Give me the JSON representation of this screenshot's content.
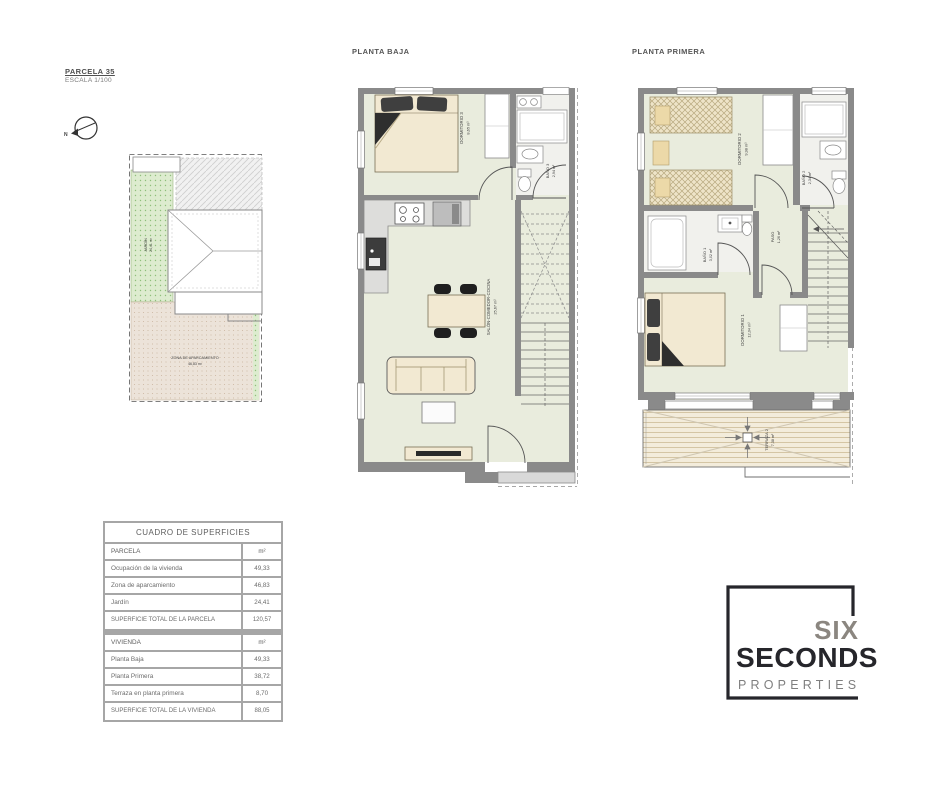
{
  "meta": {
    "parcela_title": "PARCELA 35",
    "escala": "ESCALA 1/100"
  },
  "plans": {
    "baja": {
      "label": "PLANTA BAJA",
      "rooms": [
        {
          "name": "DORMITORIO 3",
          "area": "8,65 m²"
        },
        {
          "name": "BAÑO 3",
          "area": "2,94 m²"
        },
        {
          "name": "SALÓN-COMEDOR-COCINA",
          "area": "25,67 m²"
        }
      ]
    },
    "primera": {
      "label": "PLANTA PRIMERA",
      "rooms": [
        {
          "name": "DORMITORIO 2",
          "area": "9,98 m²"
        },
        {
          "name": "BAÑO 2",
          "area": "2,34 m²"
        },
        {
          "name": "BAÑO 1",
          "area": "3,02 m²"
        },
        {
          "name": "PASO",
          "area": "1,26 m²"
        },
        {
          "name": "DORMITORIO 1",
          "area": "12,04 m²"
        },
        {
          "name": "TERRAZA 2",
          "area": "7,38 m²"
        }
      ]
    }
  },
  "site": {
    "jardin": {
      "name": "JARDÍN",
      "area": "24,41 m²"
    },
    "parking": {
      "name": "ZONA DE APARCAMIENTO",
      "area": "46,83 m²"
    }
  },
  "table": {
    "title": "CUADRO DE SUPERFICIES",
    "parcela": {
      "header": "PARCELA",
      "unit": "m²",
      "rows": [
        {
          "label": "Ocupación de la vivienda",
          "value": "49,33"
        },
        {
          "label": "Zona de aparcamiento",
          "value": "46,83"
        },
        {
          "label": "Jardín",
          "value": "24,41"
        }
      ],
      "total_label": "SUPERFICIE TOTAL DE LA PARCELA",
      "total_value": "120,57"
    },
    "vivienda": {
      "header": "VIVIENDA",
      "unit": "m²",
      "rows": [
        {
          "label": "Planta Baja",
          "value": "49,33"
        },
        {
          "label": "Planta Primera",
          "value": "38,72"
        },
        {
          "label": "Terraza en planta primera",
          "value": "8,70"
        }
      ],
      "total_label": "SUPERFICIE TOTAL DE LA VIVIENDA",
      "total_value": "88,05"
    }
  },
  "logo": {
    "word1": "SIX",
    "word2": "SECONDS",
    "word3": "PROPERTIES"
  },
  "colors": {
    "wall": "#8a8a8a",
    "floor": "#e9ecdd",
    "furniture": "#f2e9d2",
    "logo_dark": "#26262b",
    "logo_gray": "#8b8680",
    "garden": "#ddeccf",
    "parking": "#ece2d8"
  }
}
